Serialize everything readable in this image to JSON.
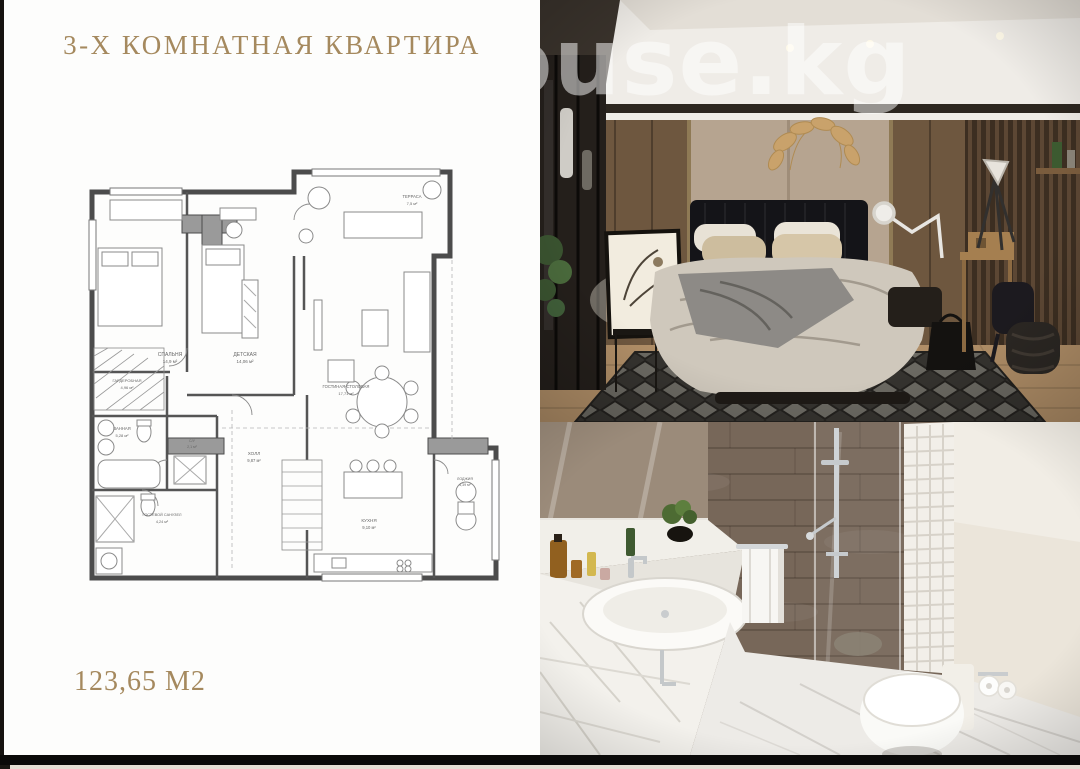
{
  "header": {
    "title": "3-Х КОМНАТНАЯ КВАРТИРА"
  },
  "plan": {
    "total_area": "123,65 М2",
    "rooms": [
      {
        "name": "СПАЛЬНЯ",
        "area": "14,9 м²"
      },
      {
        "name": "ДЕТСКАЯ",
        "area": "14,06 м²"
      },
      {
        "name": "ТЕРРАСА",
        "area": "7,5 м²"
      },
      {
        "name": "ГОСТИНАЯ-СТОЛОВАЯ",
        "area": "17,71 м²"
      },
      {
        "name": "ГАРДЕРОБНАЯ",
        "area": "4,96 м²"
      },
      {
        "name": "ВАННАЯ",
        "area": "5,28 м²"
      },
      {
        "name": "ХОЛЛ",
        "area": "9,87 м²"
      },
      {
        "name": "ГОСТЕВОЙ САНУЗЕЛ",
        "area": "4,24 м²"
      },
      {
        "name": "КУХНЯ",
        "area": "9,10 м²"
      },
      {
        "name": "ЛОДЖИЯ",
        "area": "4,39 м²"
      },
      {
        "name": "С/У",
        "area": "2,1 м²"
      }
    ]
  },
  "watermark": {
    "text": "ouse.kg"
  },
  "colors": {
    "accent_gold": "#a5895e",
    "plan_wall": "#4c4c4c",
    "frame_black": "#0b0a09"
  }
}
